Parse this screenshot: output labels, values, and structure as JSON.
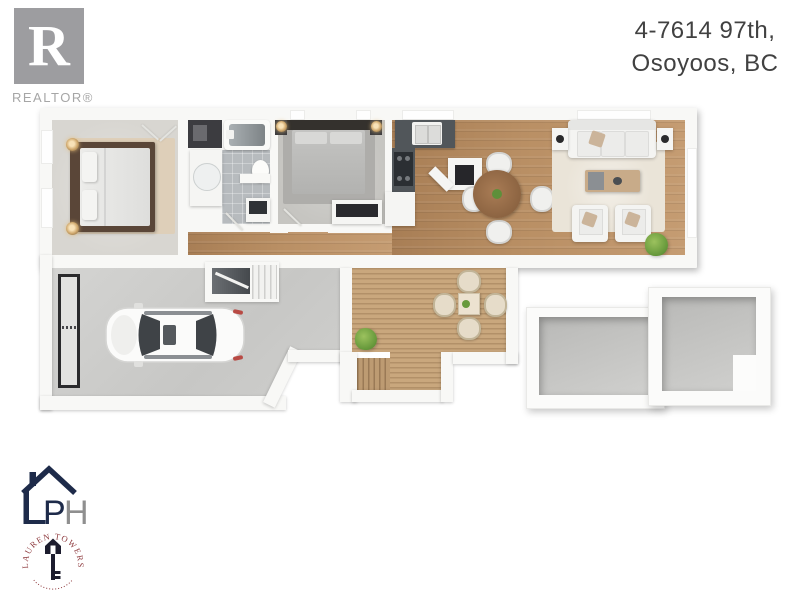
{
  "header": {
    "address_line1": "4-7614 97th,",
    "address_line2": "Osoyoos, BC"
  },
  "branding": {
    "realtor_letter": "R",
    "realtor_label": "REALTOR®",
    "ph_letter_p": "P",
    "ph_letter_h": "H",
    "seal_name": "LAUREN TOWERS"
  },
  "palette": {
    "wall": "#f8f8f6",
    "wood_floor": "#b98f64",
    "deck_wood": "#c9a77d",
    "garage_concrete": "#cdcdcb",
    "carpet_master": "#d8d6d1",
    "carpet_bedroom2": "#c6c5c1",
    "bath_tile": "#b7bbbe",
    "kitchen_counter": "#51565a",
    "living_rug": "#eae4d8",
    "master_rug": "#decfb9",
    "plant_green": "#689a3c",
    "logo_gray": "#9d9da0",
    "logo_navy": "#1e2b4a",
    "seal_maroon": "#8e3a3e",
    "car_taillight": "#b84a44"
  },
  "floor_plan": {
    "rooms": [
      "master-bedroom",
      "closet",
      "bathroom",
      "hallway",
      "bedroom-2",
      "kitchen",
      "dining-area",
      "living-room",
      "garage",
      "stairwell",
      "deck",
      "deck-stairs",
      "storage-box-1",
      "storage-box-2"
    ]
  }
}
